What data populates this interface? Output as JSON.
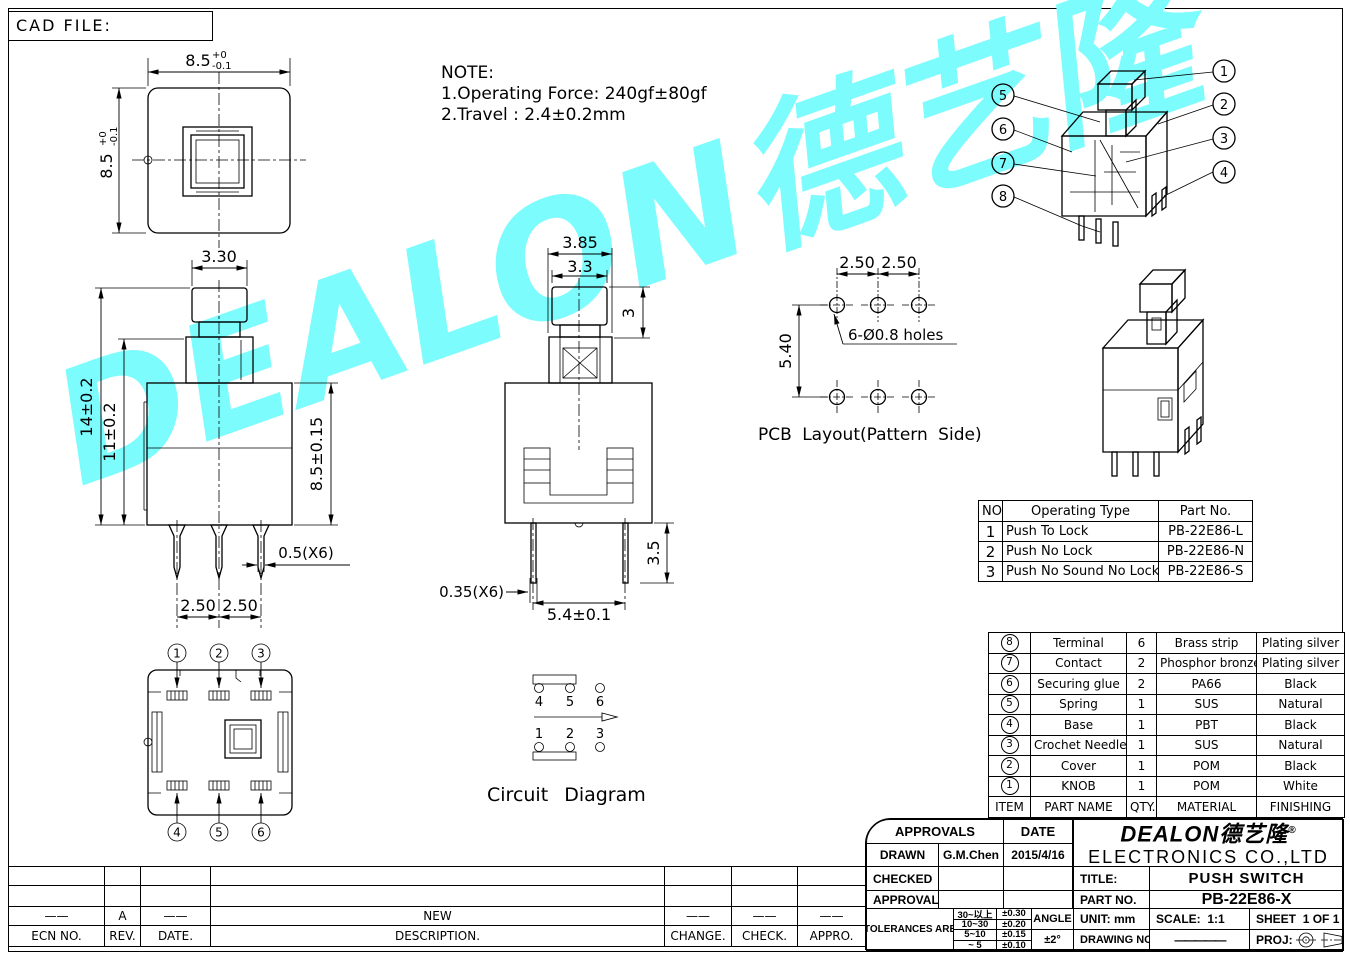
{
  "cad_file_label": "CAD FILE:",
  "note": {
    "heading": "NOTE:",
    "line1": "1.Operating Force: 240gf±80gf",
    "line2": "2.Travel : 2.4±0.2mm"
  },
  "watermark": {
    "text": "DEALON德艺隆",
    "color": "#7dfcfd"
  },
  "dims": {
    "tv_w": "8.5",
    "tv_tol_p": "+0",
    "tv_tol_m": "-0.1",
    "fv_knob_w": "3.30",
    "fv_total_h": "14±0.2",
    "fv_mid_h": "11±0.2",
    "fv_body_h": "8.5±0.15",
    "fv_pin_w": "0.5(X6)",
    "fv_pitch1": "2.50",
    "fv_pitch2": "2.50",
    "sv_collar_w": "3.85",
    "sv_knob_w": "3.3",
    "sv_knob_h": "3",
    "sv_pin_t": "0.35(X6)",
    "sv_pitch": "5.4±0.1",
    "sv_pin_len": "3.5",
    "pcb_p1": "2.50",
    "pcb_p2": "2.50",
    "pcb_row": "5.40",
    "pcb_holes": "6-Ø0.8 holes"
  },
  "captions": {
    "pcb": "PCB Layout(Pattern Side)",
    "circuit": "Circuit Diagram"
  },
  "circuit": {
    "top": [
      "4",
      "5",
      "6"
    ],
    "bottom": [
      "1",
      "2",
      "3"
    ]
  },
  "callouts": {
    "left": [
      "5",
      "6",
      "7",
      "8"
    ],
    "right": [
      "1",
      "2",
      "3",
      "4"
    ],
    "bv_top": [
      "1",
      "2",
      "3"
    ],
    "bv_bottom": [
      "4",
      "5",
      "6"
    ]
  },
  "operating_table": {
    "headers": [
      "NO.",
      "Operating Type",
      "Part No."
    ],
    "rows": [
      [
        "1",
        "Push To Lock",
        "PB-22E86-L"
      ],
      [
        "2",
        "Push No Lock",
        "PB-22E86-N"
      ],
      [
        "3",
        "Push No Sound No Lock",
        "PB-22E86-S"
      ]
    ]
  },
  "bom_table": {
    "rows": [
      [
        "8",
        "Terminal",
        "6",
        "Brass strip",
        "Plating silver"
      ],
      [
        "7",
        "Contact",
        "2",
        "Phosphor bronze",
        "Plating silver"
      ],
      [
        "6",
        "Securing glue",
        "2",
        "PA66",
        "Black"
      ],
      [
        "5",
        "Spring",
        "1",
        "SUS",
        "Natural"
      ],
      [
        "4",
        "Base",
        "1",
        "PBT",
        "Black"
      ],
      [
        "3",
        "Crochet Needle",
        "1",
        "SUS",
        "Natural"
      ],
      [
        "2",
        "Cover",
        "1",
        "POM",
        "Black"
      ],
      [
        "1",
        "KNOB",
        "1",
        "POM",
        "White"
      ]
    ],
    "footer": [
      "ITEM",
      "PART NAME",
      "QTY.",
      "MATERIAL",
      "FINISHING"
    ]
  },
  "title_block": {
    "approvals_header": "APPROVALS",
    "date_header": "DATE",
    "drawn_label": "DRAWN",
    "drawn_name": "G.M.Chen",
    "drawn_date": "2015/4/16",
    "checked_label": "CHECKED",
    "approvals_label": "APPROVALS",
    "tolerances_label": "TOLERANCES ARE",
    "tol_rows": [
      [
        "30~以上",
        "±0.30"
      ],
      [
        "10~30",
        "±0.20"
      ],
      [
        "5~10",
        "±0.15"
      ],
      [
        "~ 5",
        "±0.10"
      ]
    ],
    "angle_label": "ANGLE",
    "angle_value": "±2°",
    "logo_text": "DEALON德艺隆",
    "logo_reg": "®",
    "company_name": "ELECTRONICS CO.,LTD",
    "title_label": "TITLE:",
    "title_value": "PUSH SWITCH",
    "part_no_label": "PART NO.",
    "part_no_value": "PB-22E86-X",
    "unit_label": "UNIT:",
    "unit_value": "mm",
    "scale_label": "SCALE:",
    "scale_value": "1:1",
    "sheet_label": "SHEET",
    "sheet_value": "1 OF 1",
    "drawing_no_label": "DRAWING NO.",
    "drawing_no_value": "—————",
    "proj_label": "PROJ:"
  },
  "revision_table": {
    "new_row": [
      "——",
      "A",
      "——",
      "NEW",
      "——",
      "——",
      "——"
    ],
    "headers": [
      "ECN NO.",
      "REV.",
      "DATE.",
      "DESCRIPTION.",
      "CHANGE.",
      "CHECK.",
      "APPRO."
    ]
  }
}
